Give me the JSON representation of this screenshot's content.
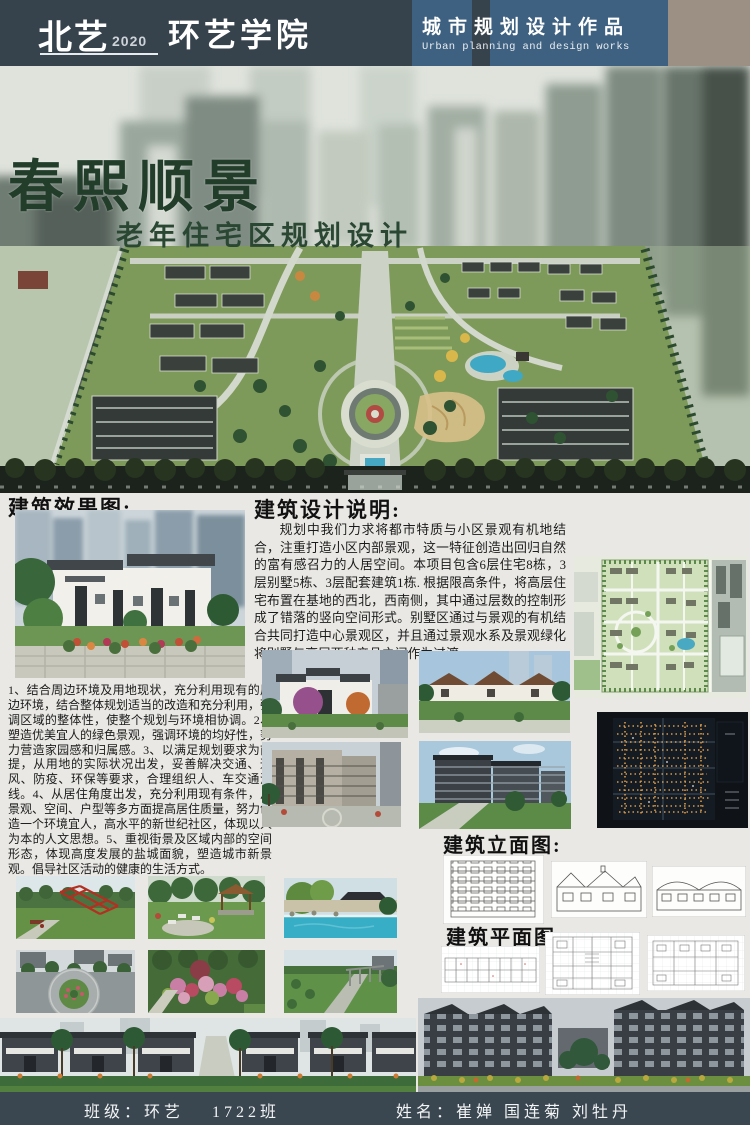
{
  "header": {
    "brand": "北艺",
    "brand_year": "2020",
    "school": "环艺学院",
    "category_cn": "城市规划设计作品",
    "category_en": "Urban planning and design works"
  },
  "hero": {
    "title": "春熙顺景",
    "subtitle": "老年住宅区规划设计"
  },
  "renderings": {
    "heading": "建筑效果图:"
  },
  "description": {
    "heading": "建筑设计说明:",
    "paragraph": "规划中我们力求将都市特质与小区景观有机地结合，注重打造小区内部景观，这一特征创造出回归自然的富有感召力的人居空间。本项目包含6层住宅8栋，3层别墅5栋、3层配套建筑1栋. 根据限高条件，将高层住宅布置在基地的西北，西南侧，其中通过层数的控制形成了错落的竖向空间形式。别墅区通过与景观的有机结合共同打造中心景观区，并且通过景观水系及景观绿化将别墅与高层两种产品之间作为过渡。",
    "points": "1、结合周边环境及用地现状，充分利用现有的周边环境，结合整体规划适当的改造和充分利用，强调区域的整体性，使整个规划与环境相协调。2、塑造优美宜人的绿色景观，强调环境的均好性，努力营造家园感和归属感。3、以满足规划要求为前提，从用地的实际状况出发，妥善解决交通、通风、防疫、环保等要求，合理组织人、车交通流线。4、从居住角度出发，充分利用现有条件，从景观、空间、户型等多方面提高居住质量，努力创造一个环境宜人，高水平的新世纪社区，体现以人为本的人文思想。5、重视街景及区域内部的空间形态，体现高度发展的盐城面貌，塑造城市新景观。倡导社区活动的健康的生活方式。"
  },
  "elevations": {
    "heading": "建筑立面图:"
  },
  "plans": {
    "heading": "建筑平面图:"
  },
  "footer": {
    "class_info": "班级：环艺　 1722班",
    "names": "姓名：崔婵  国连菊  刘牡丹"
  },
  "colors": {
    "header_bg": "#36424c",
    "panel_blue": "#3e6181",
    "tan_block": "#9c9084",
    "footer_bg": "#3a4750",
    "title_green": "#223d2a",
    "page_bg": "#e9e8e4"
  }
}
